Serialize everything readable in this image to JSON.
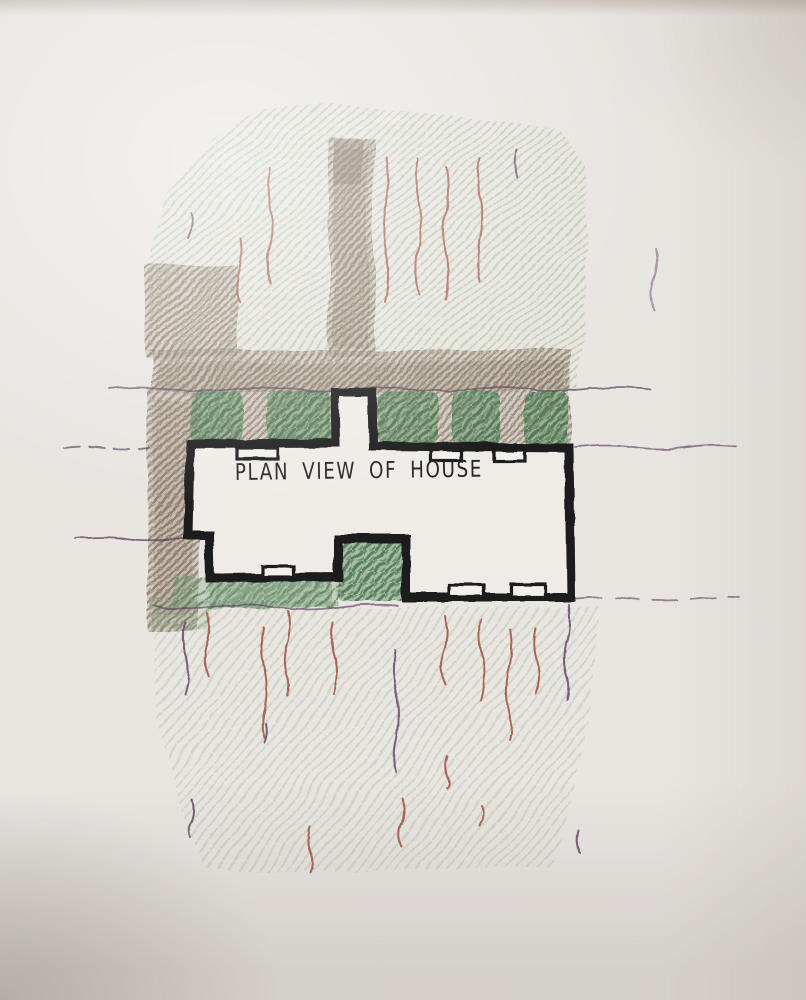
{
  "sketch": {
    "title": "PLAN VIEW OF HOUSE"
  },
  "colors": {
    "paper": "#e9e5e1",
    "house_fill": "#efece7",
    "marker_black": "#1b1b1b",
    "ink_text": "#262626",
    "lawn_hatch_green": "#b6c7aa",
    "lawn_hatch_green_soft": "#bfcab4",
    "hedge_green_dark": "#436f49",
    "hedge_green_mid": "#6f9a72",
    "pencil_brown": "#93836e",
    "pencil_brown_dark": "#6f6254",
    "pencil_red": "#a0513f",
    "pencil_purple": "#5c3e5e"
  }
}
